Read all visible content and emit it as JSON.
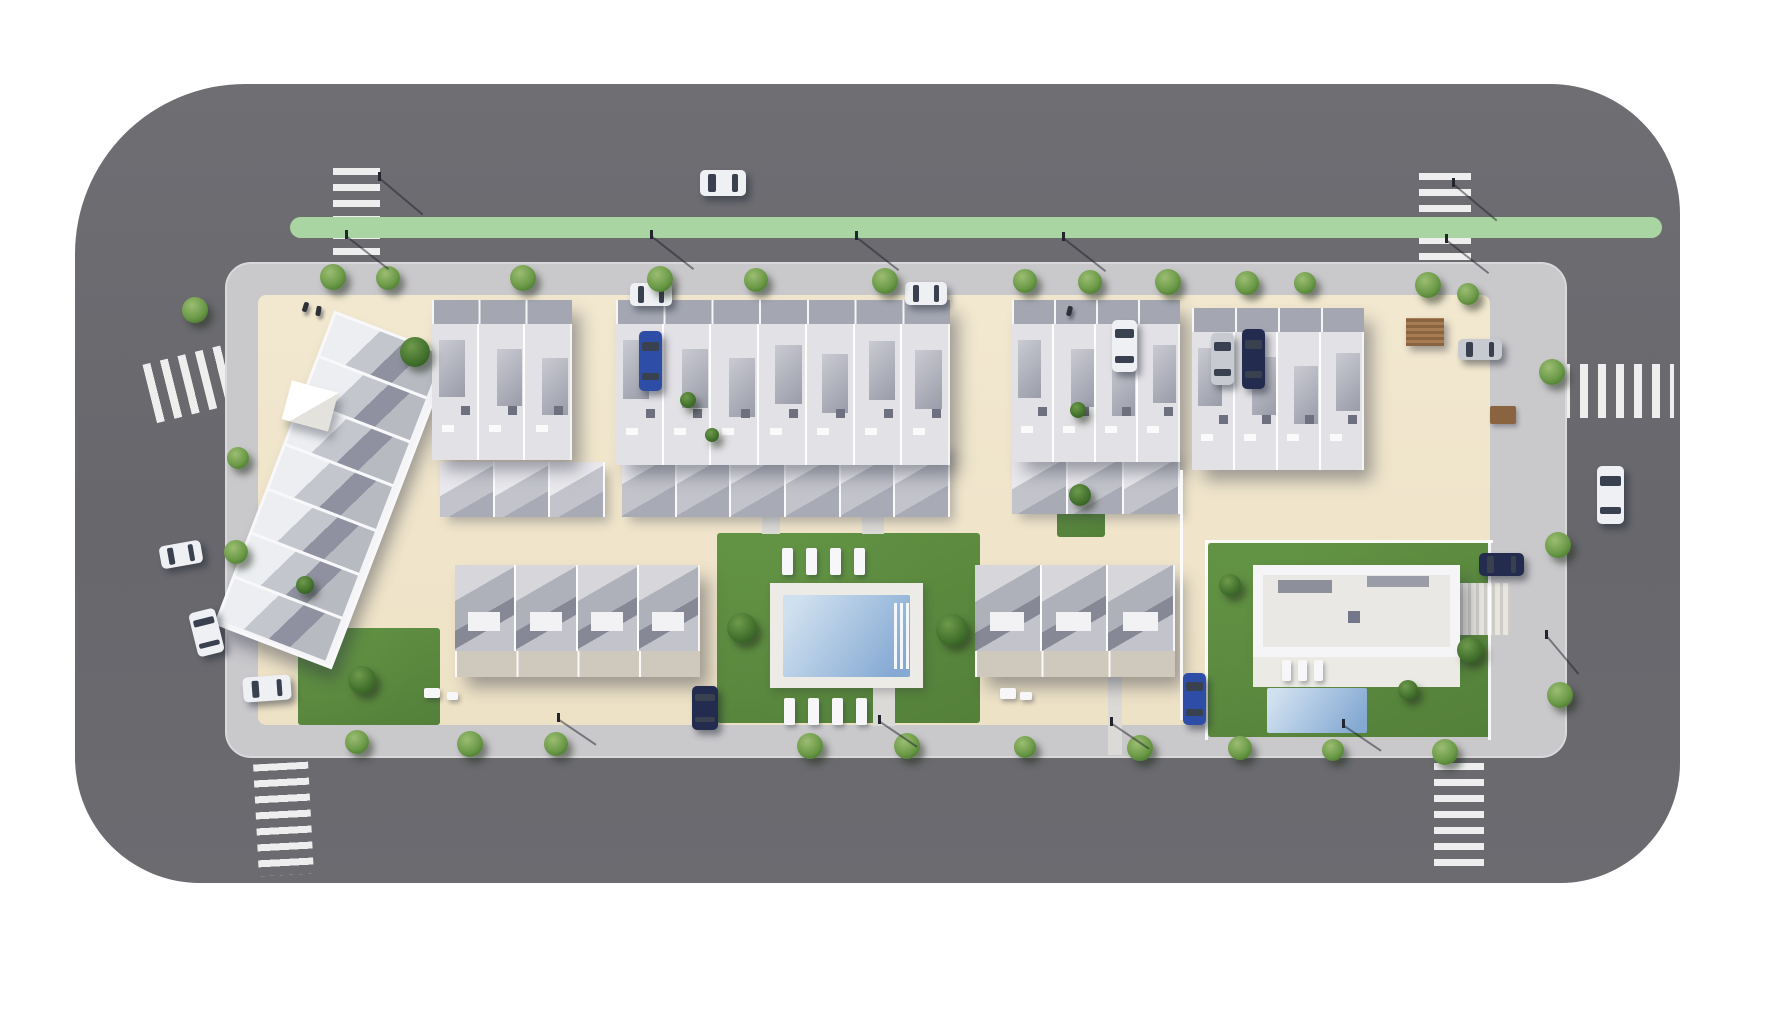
{
  "meta": {
    "width": 1780,
    "height": 1024,
    "description": "aerial-3d-site-plan-render"
  },
  "colors": {
    "asphalt": "#6b6b70",
    "sidewalk": "#c9c8cb",
    "plot": "#f0e5cb",
    "median_green": "#a8d5a1",
    "lawn": "#619243",
    "lawn_dark": "#3f652f",
    "lawn_light": "#79a855",
    "pool_light": "#cfe0ef",
    "pool_deep": "#84a9d3",
    "deck": "#edebe6",
    "building_white": "#f5f5f7",
    "roof_light": "#e2e1e5",
    "roof_mid": "#b5b6bf",
    "roof_dark": "#8b8c9a",
    "front_band": "#a4a7b2",
    "patio_band": "#cfc9bd",
    "ramp_gray": "#55555d",
    "pergola_brown": "#8a6340",
    "car_white": "#eef0f3",
    "car_blue": "#2e4da6",
    "car_navy": "#232c4e",
    "car_silver": "#c7cad0"
  },
  "layers": {
    "roads": [
      {
        "x": 75,
        "y": 84,
        "w": 1605,
        "h": 799,
        "r": "170px 130px 120px 125px"
      }
    ],
    "crosswalks": [
      {
        "x": 333,
        "y": 168,
        "w": 47,
        "h": 120,
        "dir": "v",
        "rot": 0
      },
      {
        "x": 1419,
        "y": 173,
        "w": 52,
        "h": 104,
        "dir": "v",
        "rot": 0
      },
      {
        "x": 148,
        "y": 350,
        "w": 116,
        "h": 60,
        "dir": "h",
        "rot": -14
      },
      {
        "x": 256,
        "y": 763,
        "w": 55,
        "h": 112,
        "dir": "v",
        "rot": -3
      },
      {
        "x": 1434,
        "y": 763,
        "w": 50,
        "h": 108,
        "dir": "v",
        "rot": 0
      },
      {
        "x": 1562,
        "y": 364,
        "w": 112,
        "h": 54,
        "dir": "h",
        "rot": 0
      }
    ],
    "medians": [
      {
        "x": 290,
        "y": 217,
        "w": 1372,
        "h": 21,
        "r": "11px"
      }
    ],
    "laneLines": [
      {
        "x": 610,
        "y": 281,
        "w": 838,
        "h": 3
      }
    ],
    "sidewalks": [
      {
        "x": 225,
        "y": 262,
        "w": 1342,
        "h": 496,
        "r": "26px"
      }
    ],
    "plots": [
      {
        "x": 258,
        "y": 295,
        "w": 1232,
        "h": 430,
        "r": "8px"
      }
    ],
    "lawns": [
      {
        "x": 352,
        "y": 330,
        "w": 118,
        "h": 82,
        "c": "lawn_dark"
      },
      {
        "x": 676,
        "y": 368,
        "w": 26,
        "h": 122,
        "c": "lawn_dark"
      },
      {
        "x": 440,
        "y": 553,
        "w": 17,
        "h": 110,
        "c": "lawn_dark"
      },
      {
        "x": 717,
        "y": 533,
        "w": 263,
        "h": 190,
        "c": "lawn"
      },
      {
        "x": 720,
        "y": 712,
        "w": 112,
        "h": 11,
        "c": "lawn_dark"
      },
      {
        "x": 298,
        "y": 628,
        "w": 142,
        "h": 97,
        "c": "lawn"
      },
      {
        "x": 1057,
        "y": 462,
        "w": 48,
        "h": 75,
        "c": "lawn"
      },
      {
        "x": 1208,
        "y": 543,
        "w": 282,
        "h": 194,
        "c": "lawn"
      },
      {
        "x": 1056,
        "y": 390,
        "w": 44,
        "h": 46,
        "c": "lawn"
      }
    ],
    "paths": [
      {
        "x": 762,
        "y": 458,
        "w": 18,
        "h": 76,
        "kind": "walk"
      },
      {
        "x": 862,
        "y": 500,
        "w": 22,
        "h": 34,
        "kind": "walk"
      },
      {
        "x": 873,
        "y": 688,
        "w": 22,
        "h": 38,
        "kind": "walk"
      },
      {
        "x": 1108,
        "y": 677,
        "w": 14,
        "h": 78,
        "kind": "walk"
      },
      {
        "x": 1455,
        "y": 583,
        "w": 55,
        "h": 52,
        "kind": "stairs"
      }
    ],
    "ramps": [
      {
        "x": 1050,
        "y": 302,
        "w": 92,
        "h": 168
      }
    ],
    "poolDecks": [
      {
        "x": 770,
        "y": 583,
        "w": 153,
        "h": 105
      }
    ],
    "pools": [
      {
        "x": 783,
        "y": 595,
        "w": 127,
        "h": 82,
        "steps": true
      },
      {
        "x": 1267,
        "y": 688,
        "w": 100,
        "h": 45,
        "steps": false
      }
    ],
    "rearBands": [
      {
        "x": 440,
        "y": 462,
        "w": 165,
        "h": 55,
        "units": 3
      },
      {
        "x": 622,
        "y": 442,
        "w": 328,
        "h": 75,
        "units": 6
      },
      {
        "x": 1012,
        "y": 452,
        "w": 168,
        "h": 62,
        "units": 3
      }
    ],
    "buildings": [
      {
        "type": "diag",
        "x": 270,
        "y": 322,
        "w": 120,
        "h": 330,
        "rot": 21,
        "units": 7
      },
      {
        "type": "canopy",
        "x": 286,
        "y": 386,
        "w": 48,
        "h": 40,
        "rot": 15
      },
      {
        "type": "apt",
        "x": 432,
        "y": 300,
        "w": 140,
        "h": 160,
        "units": 3
      },
      {
        "type": "apt",
        "x": 616,
        "y": 300,
        "w": 334,
        "h": 165,
        "units": 7
      },
      {
        "type": "apt",
        "x": 1012,
        "y": 300,
        "w": 168,
        "h": 162,
        "units": 4
      },
      {
        "type": "apt",
        "x": 1192,
        "y": 308,
        "w": 172,
        "h": 162,
        "units": 4
      },
      {
        "type": "row",
        "x": 455,
        "y": 565,
        "w": 245,
        "h": 112,
        "units": 4,
        "band": true
      },
      {
        "type": "row",
        "x": 975,
        "y": 565,
        "w": 200,
        "h": 112,
        "units": 3,
        "band": true
      },
      {
        "type": "villa",
        "x": 1253,
        "y": 565,
        "w": 207,
        "h": 92
      },
      {
        "type": "villadeck",
        "x": 1253,
        "y": 657,
        "w": 207,
        "h": 30
      },
      {
        "type": "pergola",
        "x": 1406,
        "y": 318,
        "w": 38,
        "h": 28
      }
    ],
    "fences": [
      {
        "x": 1205,
        "y": 540,
        "w": 288,
        "h": 3
      },
      {
        "x": 1205,
        "y": 540,
        "w": 3,
        "h": 200
      },
      {
        "x": 1488,
        "y": 540,
        "w": 3,
        "h": 200
      },
      {
        "x": 1180,
        "y": 470,
        "w": 3,
        "h": 250
      }
    ],
    "furniture": [
      {
        "x": 782,
        "y": 548,
        "w": 11,
        "h": 27,
        "c": "white"
      },
      {
        "x": 806,
        "y": 548,
        "w": 11,
        "h": 27,
        "c": "white"
      },
      {
        "x": 830,
        "y": 548,
        "w": 11,
        "h": 27,
        "c": "white"
      },
      {
        "x": 854,
        "y": 548,
        "w": 11,
        "h": 27,
        "c": "white"
      },
      {
        "x": 784,
        "y": 698,
        "w": 11,
        "h": 27,
        "c": "white"
      },
      {
        "x": 808,
        "y": 698,
        "w": 11,
        "h": 27,
        "c": "white"
      },
      {
        "x": 832,
        "y": 698,
        "w": 11,
        "h": 27,
        "c": "white"
      },
      {
        "x": 856,
        "y": 698,
        "w": 11,
        "h": 27,
        "c": "white"
      },
      {
        "x": 1282,
        "y": 660,
        "w": 9,
        "h": 21,
        "c": "white"
      },
      {
        "x": 1298,
        "y": 660,
        "w": 9,
        "h": 21,
        "c": "white"
      },
      {
        "x": 1314,
        "y": 660,
        "w": 9,
        "h": 21,
        "c": "white"
      },
      {
        "x": 1000,
        "y": 688,
        "w": 16,
        "h": 11,
        "c": "white"
      },
      {
        "x": 1020,
        "y": 692,
        "w": 12,
        "h": 8,
        "c": "white"
      },
      {
        "x": 424,
        "y": 688,
        "w": 16,
        "h": 10,
        "c": "white"
      },
      {
        "x": 447,
        "y": 692,
        "w": 11,
        "h": 8,
        "c": "white"
      },
      {
        "x": 1490,
        "y": 406,
        "w": 26,
        "h": 18,
        "c": "brown"
      }
    ],
    "cars": [
      {
        "x": 700,
        "y": 170,
        "w": 46,
        "h": 26,
        "c": "white",
        "rot": 0
      },
      {
        "x": 630,
        "y": 283,
        "w": 42,
        "h": 23,
        "c": "white",
        "rot": 0
      },
      {
        "x": 905,
        "y": 282,
        "w": 42,
        "h": 23,
        "c": "white",
        "rot": 0
      },
      {
        "x": 639,
        "y": 331,
        "w": 23,
        "h": 60,
        "c": "blue",
        "rot": 0
      },
      {
        "x": 1112,
        "y": 320,
        "w": 25,
        "h": 52,
        "c": "white",
        "rot": 0
      },
      {
        "x": 1211,
        "y": 333,
        "w": 23,
        "h": 52,
        "c": "silver",
        "rot": 0
      },
      {
        "x": 1242,
        "y": 329,
        "w": 23,
        "h": 60,
        "c": "navy",
        "rot": 0
      },
      {
        "x": 1458,
        "y": 339,
        "w": 44,
        "h": 21,
        "c": "silver",
        "rot": 0
      },
      {
        "x": 1597,
        "y": 466,
        "w": 27,
        "h": 58,
        "c": "white",
        "rot": 0
      },
      {
        "x": 160,
        "y": 543,
        "w": 42,
        "h": 23,
        "c": "white",
        "rot": -10
      },
      {
        "x": 193,
        "y": 610,
        "w": 27,
        "h": 45,
        "c": "white",
        "rot": -14
      },
      {
        "x": 243,
        "y": 676,
        "w": 48,
        "h": 25,
        "c": "white",
        "rot": -4
      },
      {
        "x": 692,
        "y": 686,
        "w": 26,
        "h": 44,
        "c": "navy",
        "rot": 0
      },
      {
        "x": 1183,
        "y": 673,
        "w": 23,
        "h": 52,
        "c": "blue",
        "rot": 0
      },
      {
        "x": 1479,
        "y": 553,
        "w": 45,
        "h": 23,
        "c": "navy",
        "rot": 0
      }
    ],
    "trees": [
      {
        "x": 333,
        "y": 277,
        "d": 26
      },
      {
        "x": 388,
        "y": 278,
        "d": 24
      },
      {
        "x": 523,
        "y": 278,
        "d": 26
      },
      {
        "x": 660,
        "y": 279,
        "d": 26
      },
      {
        "x": 756,
        "y": 280,
        "d": 24
      },
      {
        "x": 885,
        "y": 281,
        "d": 26
      },
      {
        "x": 1025,
        "y": 281,
        "d": 24
      },
      {
        "x": 1090,
        "y": 282,
        "d": 24
      },
      {
        "x": 1168,
        "y": 282,
        "d": 26
      },
      {
        "x": 1247,
        "y": 283,
        "d": 24
      },
      {
        "x": 1305,
        "y": 283,
        "d": 22
      },
      {
        "x": 1428,
        "y": 285,
        "d": 26
      },
      {
        "x": 1468,
        "y": 294,
        "d": 22
      },
      {
        "x": 357,
        "y": 742,
        "d": 24
      },
      {
        "x": 470,
        "y": 744,
        "d": 26
      },
      {
        "x": 556,
        "y": 744,
        "d": 24
      },
      {
        "x": 810,
        "y": 746,
        "d": 26
      },
      {
        "x": 907,
        "y": 746,
        "d": 26
      },
      {
        "x": 1025,
        "y": 747,
        "d": 22
      },
      {
        "x": 1140,
        "y": 748,
        "d": 26
      },
      {
        "x": 1240,
        "y": 748,
        "d": 24
      },
      {
        "x": 1333,
        "y": 750,
        "d": 22
      },
      {
        "x": 1445,
        "y": 752,
        "d": 26
      },
      {
        "x": 195,
        "y": 310,
        "d": 26
      },
      {
        "x": 238,
        "y": 458,
        "d": 22
      },
      {
        "x": 236,
        "y": 552,
        "d": 24
      },
      {
        "x": 1552,
        "y": 372,
        "d": 26
      },
      {
        "x": 1558,
        "y": 545,
        "d": 26
      },
      {
        "x": 1560,
        "y": 695,
        "d": 26
      },
      {
        "x": 415,
        "y": 352,
        "d": 30,
        "v": "dark"
      },
      {
        "x": 742,
        "y": 628,
        "d": 30,
        "v": "dark"
      },
      {
        "x": 952,
        "y": 630,
        "d": 32,
        "v": "dark"
      },
      {
        "x": 362,
        "y": 680,
        "d": 28,
        "v": "dark"
      },
      {
        "x": 1080,
        "y": 495,
        "d": 22,
        "v": "dark"
      },
      {
        "x": 1230,
        "y": 585,
        "d": 22,
        "v": "dark"
      },
      {
        "x": 1470,
        "y": 650,
        "d": 26,
        "v": "dark"
      },
      {
        "x": 1408,
        "y": 690,
        "d": 20,
        "v": "dark"
      },
      {
        "x": 305,
        "y": 585,
        "d": 18,
        "v": "dark"
      },
      {
        "x": 688,
        "y": 400,
        "d": 16,
        "v": "dark"
      },
      {
        "x": 712,
        "y": 435,
        "d": 14,
        "v": "dark"
      },
      {
        "x": 1078,
        "y": 410,
        "d": 16,
        "v": "dark"
      }
    ],
    "lamps": [
      {
        "x": 345,
        "y": 230,
        "len": 52,
        "rot": 38
      },
      {
        "x": 650,
        "y": 230,
        "len": 52,
        "rot": 38
      },
      {
        "x": 855,
        "y": 231,
        "len": 52,
        "rot": 38
      },
      {
        "x": 1062,
        "y": 232,
        "len": 52,
        "rot": 38
      },
      {
        "x": 1445,
        "y": 234,
        "len": 52,
        "rot": 38
      },
      {
        "x": 378,
        "y": 172,
        "len": 55,
        "rot": 40
      },
      {
        "x": 1452,
        "y": 178,
        "len": 55,
        "rot": 40
      },
      {
        "x": 557,
        "y": 713,
        "len": 44,
        "rot": 34
      },
      {
        "x": 878,
        "y": 715,
        "len": 44,
        "rot": 34
      },
      {
        "x": 1110,
        "y": 717,
        "len": 44,
        "rot": 34
      },
      {
        "x": 1342,
        "y": 719,
        "len": 44,
        "rot": 34
      },
      {
        "x": 1545,
        "y": 630,
        "len": 48,
        "rot": 50
      }
    ],
    "people": [
      {
        "x": 303,
        "y": 302,
        "rot": 18
      },
      {
        "x": 316,
        "y": 306,
        "rot": 10
      },
      {
        "x": 1067,
        "y": 306,
        "rot": 14
      }
    ]
  }
}
